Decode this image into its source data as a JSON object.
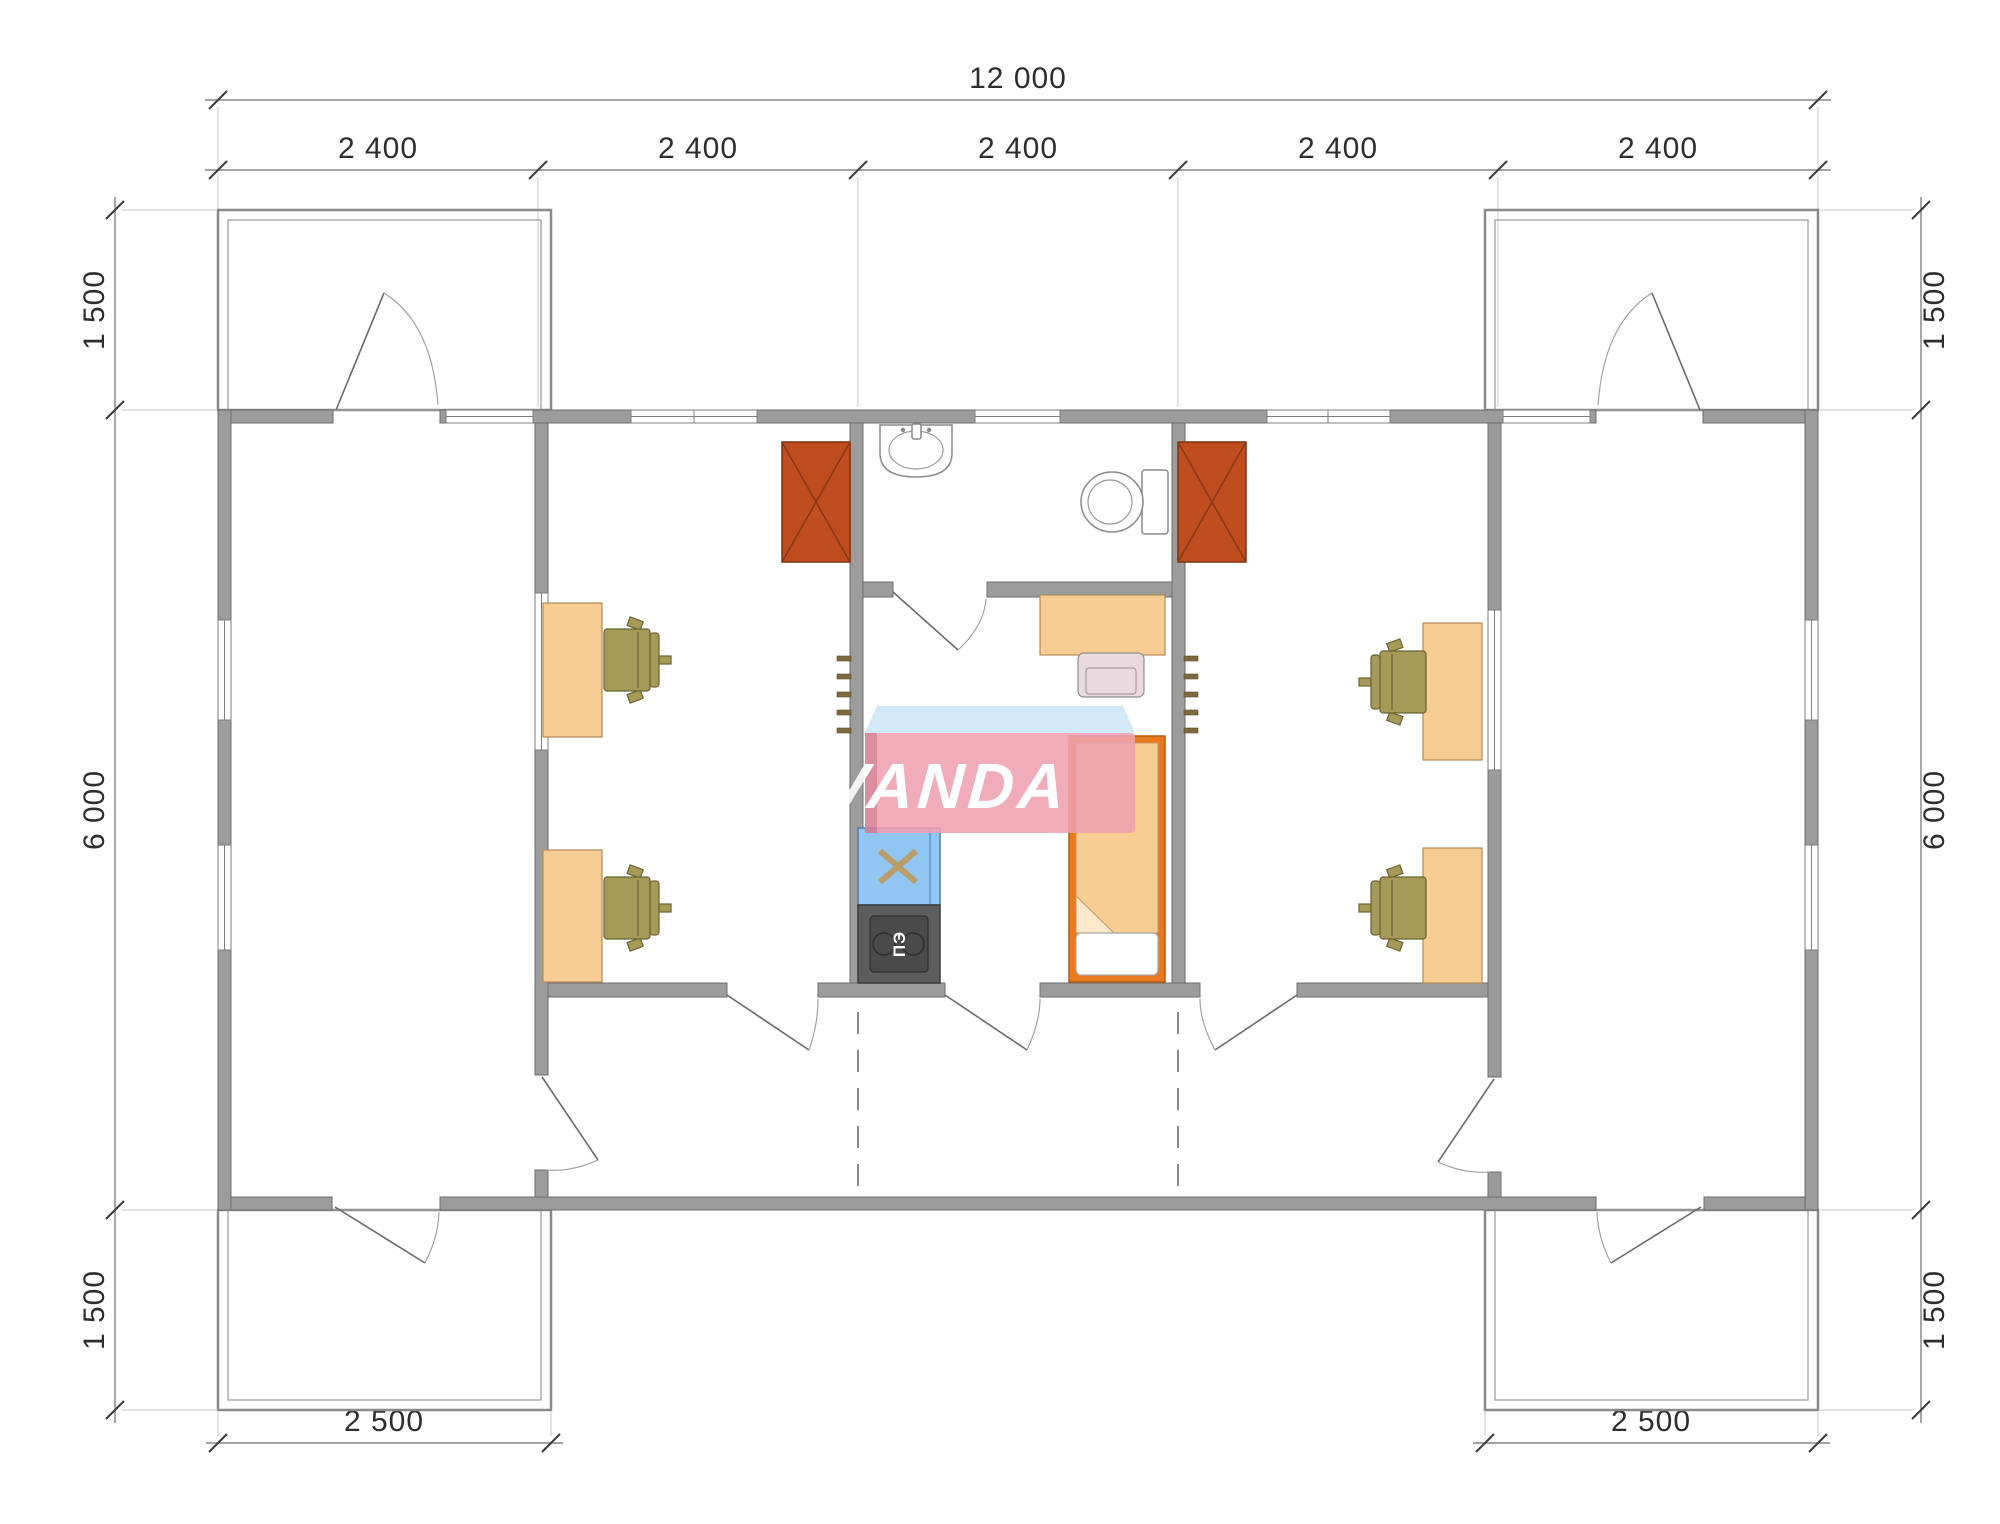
{
  "dimensions": {
    "total_width": "12 000",
    "bay_width": "2 400",
    "porch_depth_top": "1 500",
    "body_depth": "6 000",
    "porch_depth_bottom": "1 500",
    "terrace_width": "2 500"
  },
  "stove": {
    "label": "ПЭ"
  },
  "watermark": {
    "text": "VANDA",
    "body_color": "#f0a1b1",
    "top_color": "#cfe7f6",
    "text_color": "#ffffff"
  },
  "palette": {
    "wall": "#9c9c9c",
    "wardrobe": "#c04d1e",
    "desk": "#f8cd94",
    "office_chair": "#a59a58",
    "bed_frame": "#e8791f",
    "bed_blanket": "#f8cd94",
    "kitchen_sink": "#92c6f2",
    "stove_body": "#5d5d5d",
    "dimension_text": "#2e2e2e"
  }
}
